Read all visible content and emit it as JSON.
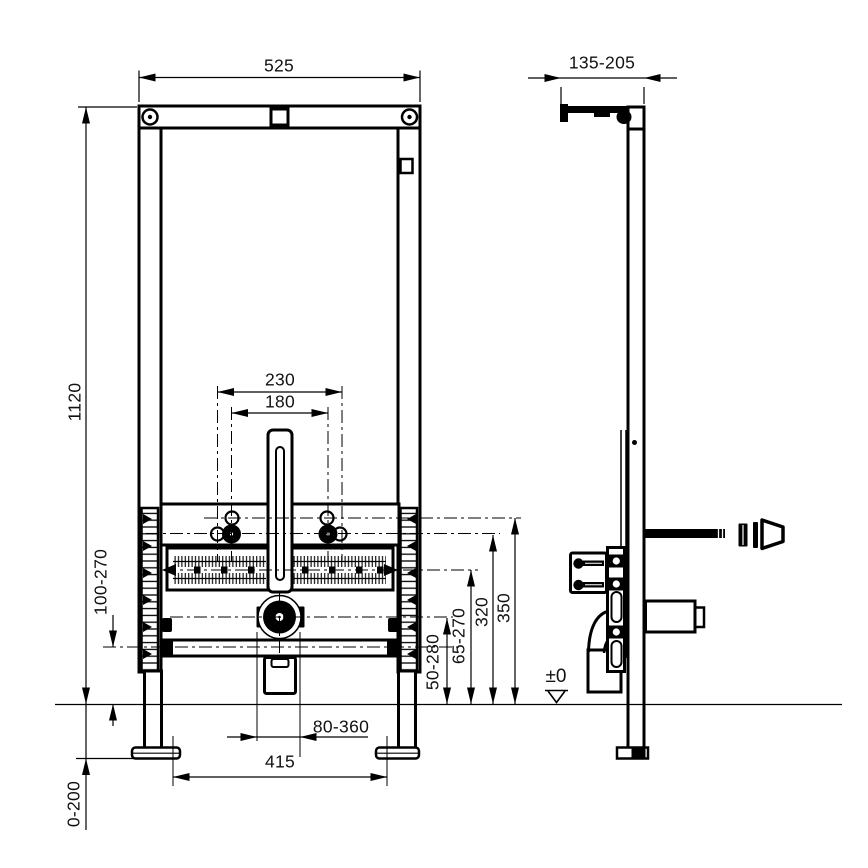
{
  "drawing": {
    "type": "technical-installation-drawing",
    "background_color": "#ffffff",
    "line_color": "#000000",
    "views": {
      "left": "front-view",
      "right": "side-view"
    },
    "dimensions": {
      "frame_width": "525",
      "wall_rail_depth": "135-205",
      "frame_height": "1120",
      "bolt_spacing_outer": "230",
      "bolt_spacing_inner": "180",
      "support_rail_height": "100-270",
      "water_connection_height": "50-280",
      "threaded_rod_height": "65-270",
      "bolt_row_height_lower": "320",
      "bolt_row_height_upper": "350",
      "floor_level": "±0",
      "drain_offset_range": "80-360",
      "foot_spacing": "415",
      "floor_adjustment": "0-200"
    }
  }
}
